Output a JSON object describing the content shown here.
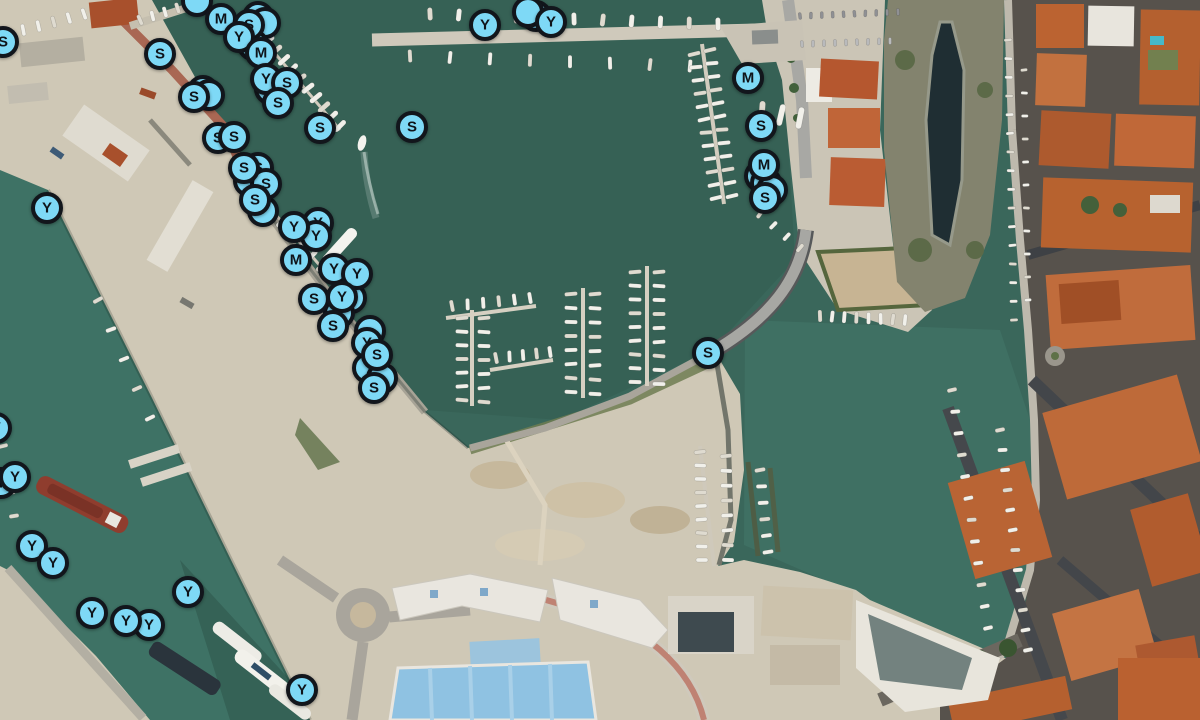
{
  "map": {
    "view": "satellite-aerial-harbor",
    "water_color": "#3A675B",
    "land_color": "#CFC8B6"
  },
  "markers": {
    "style": {
      "fill": "#7ED9F6",
      "border": "#12161C",
      "letter_color": "#0F141A",
      "diameter_px": 32
    },
    "types": [
      "S",
      "M",
      "Y"
    ],
    "pins": [
      {
        "letter": "Y",
        "x": 318,
        "y": 223
      },
      {
        "letter": "Y",
        "x": 316,
        "y": 236
      },
      {
        "letter": "S",
        "x": 258,
        "y": 168
      },
      {
        "letter": "S",
        "x": 266,
        "y": 184
      },
      {
        "letter": "S",
        "x": 244,
        "y": 168
      },
      {
        "letter": "S",
        "x": 255,
        "y": 200
      },
      {
        "letter": "M",
        "x": 221,
        "y": 19
      },
      {
        "letter": "S",
        "x": 249,
        "y": 25
      },
      {
        "letter": "Y",
        "x": 239,
        "y": 37
      },
      {
        "letter": "M",
        "x": 261,
        "y": 53
      },
      {
        "letter": "S",
        "x": 270,
        "y": 89
      },
      {
        "letter": "Y",
        "x": 266,
        "y": 79
      },
      {
        "letter": "S",
        "x": 287,
        "y": 83
      },
      {
        "letter": "S",
        "x": 278,
        "y": 103
      },
      {
        "letter": "S",
        "x": 194,
        "y": 97
      },
      {
        "letter": "S",
        "x": 160,
        "y": 54
      },
      {
        "letter": "S",
        "x": 3,
        "y": 42
      },
      {
        "letter": "S",
        "x": 320,
        "y": 128
      },
      {
        "letter": "S",
        "x": 218,
        "y": 138
      },
      {
        "letter": "S",
        "x": 234,
        "y": 137
      },
      {
        "letter": "Y",
        "x": 485,
        "y": 25
      },
      {
        "letter": "Y",
        "x": 551,
        "y": 22
      },
      {
        "letter": "S",
        "x": 412,
        "y": 127
      },
      {
        "letter": "M",
        "x": 748,
        "y": 78
      },
      {
        "letter": "S",
        "x": 761,
        "y": 126
      },
      {
        "letter": "M",
        "x": 764,
        "y": 165
      },
      {
        "letter": "S",
        "x": 765,
        "y": 198
      },
      {
        "letter": "M",
        "x": 296,
        "y": 260
      },
      {
        "letter": "Y",
        "x": 294,
        "y": 227
      },
      {
        "letter": "Y",
        "x": 334,
        "y": 269
      },
      {
        "letter": "Y",
        "x": 357,
        "y": 274
      },
      {
        "letter": "S",
        "x": 314,
        "y": 299
      },
      {
        "letter": "Y",
        "x": 342,
        "y": 297
      },
      {
        "letter": "S",
        "x": 333,
        "y": 326
      },
      {
        "letter": "Y",
        "x": 367,
        "y": 343
      },
      {
        "letter": "S",
        "x": 377,
        "y": 355
      },
      {
        "letter": "S",
        "x": 374,
        "y": 388
      },
      {
        "letter": "Y",
        "x": 47,
        "y": 208
      },
      {
        "letter": "Y",
        "x": -4,
        "y": 428
      },
      {
        "letter": "Y",
        "x": 1,
        "y": 483
      },
      {
        "letter": "Y",
        "x": 15,
        "y": 477
      },
      {
        "letter": "Y",
        "x": 32,
        "y": 546
      },
      {
        "letter": "Y",
        "x": 53,
        "y": 563
      },
      {
        "letter": "Y",
        "x": 188,
        "y": 592
      },
      {
        "letter": "Y",
        "x": 92,
        "y": 613
      },
      {
        "letter": "Y",
        "x": 149,
        "y": 625
      },
      {
        "letter": "Y",
        "x": 126,
        "y": 621
      },
      {
        "letter": "Y",
        "x": 302,
        "y": 690
      },
      {
        "letter": "S",
        "x": 708,
        "y": 353
      }
    ],
    "cluster_circles": [
      {
        "x": 197,
        "y": 1
      },
      {
        "x": 258,
        "y": 17
      },
      {
        "x": 265,
        "y": 23
      },
      {
        "x": 253,
        "y": 45
      },
      {
        "x": 203,
        "y": 91
      },
      {
        "x": 209,
        "y": 95
      },
      {
        "x": 536,
        "y": 16
      },
      {
        "x": 528,
        "y": 12
      },
      {
        "x": 249,
        "y": 181
      },
      {
        "x": 263,
        "y": 211
      },
      {
        "x": 760,
        "y": 176
      },
      {
        "x": 766,
        "y": 183
      },
      {
        "x": 772,
        "y": 190
      },
      {
        "x": 351,
        "y": 298
      },
      {
        "x": 339,
        "y": 313
      },
      {
        "x": 370,
        "y": 331
      },
      {
        "x": 368,
        "y": 368
      },
      {
        "x": 382,
        "y": 378
      }
    ]
  }
}
